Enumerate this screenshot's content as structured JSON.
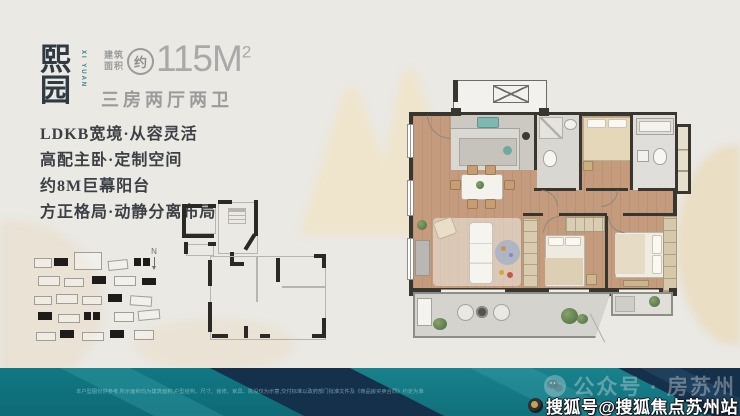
{
  "header": {
    "project_name": "熙园",
    "project_name_vertical": "XI YUAN",
    "area_label": "建筑\n面积",
    "area_badge": "约",
    "area_value": "115M",
    "area_sup": "2",
    "unit_layout": "三房两厅两卫"
  },
  "features": {
    "lines": [
      "LDKB宽境·从容灵活",
      "高配主卧·定制空间",
      "约8M巨幕阳台",
      "方正格局·动静分离布局"
    ]
  },
  "plan": {
    "north_label": "N",
    "bedrooms_label": "三房",
    "baths_label": "两卫"
  },
  "footer": {
    "disclaimer": "本户型图仅供参考,所示面积均为建筑面积,户型结构、尺寸、装修、家具、陈设仅为示意,交付标准以政府部门批准文件及《商品房买卖合同》约定为准",
    "wechat_watermark": "公众号 · 房苏州",
    "sohu_watermark": "搜狐号@搜狐焦点苏州站"
  },
  "colors": {
    "accent_teal": "#2e7f8c",
    "band_teal": "#137a84",
    "band_navy": "#14304a",
    "wood_floor": "#c49c7d",
    "wall": "#39362f",
    "background": "#ebe9e4"
  }
}
